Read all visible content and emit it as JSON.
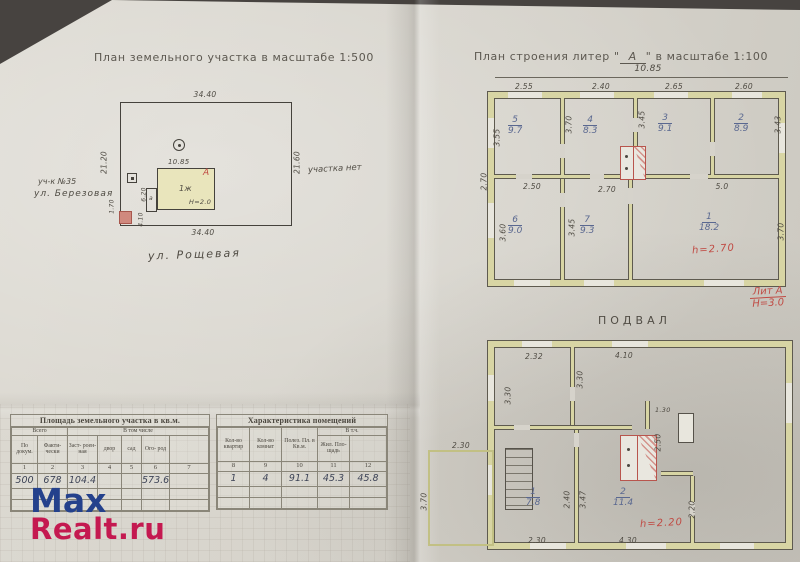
{
  "colors": {
    "red_note": "#c04b44",
    "blue_ink": "#3e4457",
    "wall_fill": "#d8d5a4",
    "watermark_blue": "#24418c",
    "watermark_red": "#c41950",
    "paper": "#d6d3cb"
  },
  "watermark": {
    "line1": "Max",
    "line2": "Realt.ru"
  },
  "left_page": {
    "title": "План земельного участка в масштабе 1:500",
    "plot": {
      "dim_top": "34.40",
      "dim_left": "21.20",
      "dim_right": "21.60",
      "dim_bottom": "34.40",
      "street": "ул. Рощевая",
      "neighbor_line1": "уч-к №35",
      "neighbor_line2": "ул. Березовая",
      "right_note": "участка нет",
      "house": {
        "dim_top": "10.85",
        "storey_label": "1ж",
        "height_label": "Н=2.0",
        "letter": "А",
        "annex_letter": "а",
        "annex_dim_a": "6.20",
        "annex_dim_b": "4.10",
        "corner_dim": "1.70"
      }
    }
  },
  "right_page": {
    "title_prefix": "План строения литер \"",
    "title_letter": "А",
    "title_suffix": "\" в масштабе 1:100",
    "overall_width": "10.85",
    "floor1": {
      "dims_top": [
        "2.55",
        "2.40",
        "2.65",
        "2.60"
      ],
      "dims_mid": [
        "2.50",
        "2.70",
        "5.0"
      ],
      "dims_left": [
        "3.55",
        "2.70",
        "3.60"
      ],
      "dims_right": [
        "3.43",
        "3.70"
      ],
      "dims_inner": [
        "3.70",
        "3.45",
        "3.45"
      ],
      "rooms": [
        {
          "num": "5",
          "area": "9.7"
        },
        {
          "num": "4",
          "area": "8.3"
        },
        {
          "num": "3",
          "area": "9.1"
        },
        {
          "num": "2",
          "area": "8.9"
        },
        {
          "num": "6",
          "area": "9.0"
        },
        {
          "num": "7",
          "area": "9.3"
        },
        {
          "num": "1",
          "area": "18.2"
        }
      ],
      "height_note": "h=2.70",
      "liter_top": "Лит А",
      "liter_bottom": "Н=3.0"
    },
    "basement_label": "ПОДВАЛ",
    "basement": {
      "dims_top": [
        "2.32",
        "4.10"
      ],
      "dim_left": "3.30",
      "dim_inner_v": "3.30",
      "dim_shelf": "1.30",
      "dim_stove": "2.50",
      "dim_r1_w": "2.40",
      "dim_r1_h": "3.47",
      "dim_right": "2.20",
      "dims_bottom": [
        "2.30",
        "4.30"
      ],
      "rooms": [
        {
          "num": "1",
          "area": "7.8"
        },
        {
          "num": "2",
          "area": "11.4"
        }
      ],
      "height_note": "h=2.20",
      "annex": {
        "dim_top": "2.30",
        "dim_left": "3.70"
      }
    }
  },
  "tables": {
    "land": {
      "title": "Площадь земельного участка в кв.м.",
      "group1": "Всего",
      "group2": "В том числе",
      "headers": [
        "По докум.",
        "Факти- чески",
        "Заст- роен- ная",
        "двор",
        "сад",
        "Ого- род",
        ""
      ],
      "numbers": [
        "1",
        "2",
        "3",
        "4",
        "5",
        "6",
        "7"
      ],
      "values": [
        "500",
        "678",
        "104.4",
        "",
        "",
        "573.6",
        ""
      ]
    },
    "premises": {
      "title": "Характеристика помещений",
      "group": "В т.ч.",
      "headers": [
        "Кол-во квартир",
        "Кол-во комнат",
        "Полез. Пл. в Кв.м.",
        "Жил. Пло- щадь",
        ""
      ],
      "numbers": [
        "8",
        "9",
        "10",
        "11",
        "12"
      ],
      "values": [
        "1",
        "4",
        "91.1",
        "45.3",
        "45.8"
      ]
    }
  }
}
